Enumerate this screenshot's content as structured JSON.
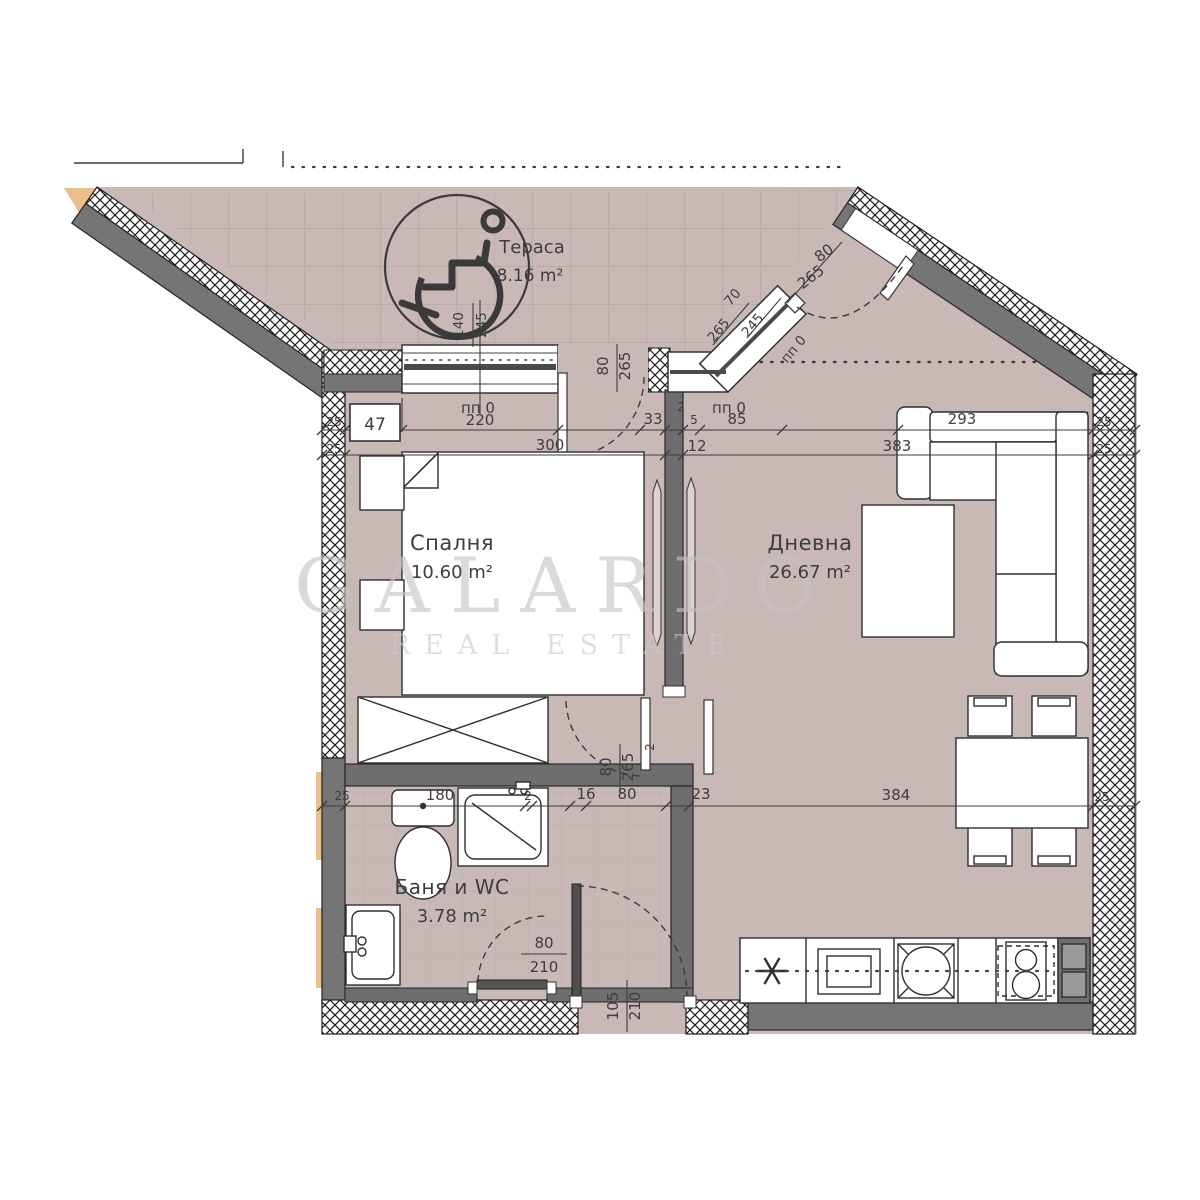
{
  "watermark": {
    "brand": "GALARDO",
    "tagline": "REAL ESTATE"
  },
  "rooms": [
    {
      "name": "Тераса",
      "area": "8.16 m²"
    },
    {
      "name": "Спалня",
      "area": "10.60 m²"
    },
    {
      "name": "Дневна",
      "area": "26.67 m²"
    },
    {
      "name": "Баня и WC",
      "area": "3.78 m²"
    }
  ],
  "openings": {
    "window_mark": "пп 0"
  },
  "dims": {
    "d2": "2",
    "d5": "5",
    "d12": "12",
    "d16": "16",
    "d23": "23",
    "d25": "25",
    "d33": "33",
    "d47": "47",
    "d70": "70",
    "d80": "80",
    "d85": "85",
    "d105": "105",
    "d140": "140",
    "d180": "180",
    "d210": "210",
    "d220": "220",
    "d245": "245",
    "d265": "265",
    "d293": "293",
    "d300": "300",
    "d383": "383",
    "d384": "384"
  },
  "symbols": {
    "wheelchair": "wheelchair-accessible-icon"
  },
  "colors": {
    "floor": "#c8b8b6",
    "wall": "#757575",
    "accent_orange": "#ecbf8a",
    "line": "#3d3d3d",
    "watermark": "#c9c2c2"
  }
}
